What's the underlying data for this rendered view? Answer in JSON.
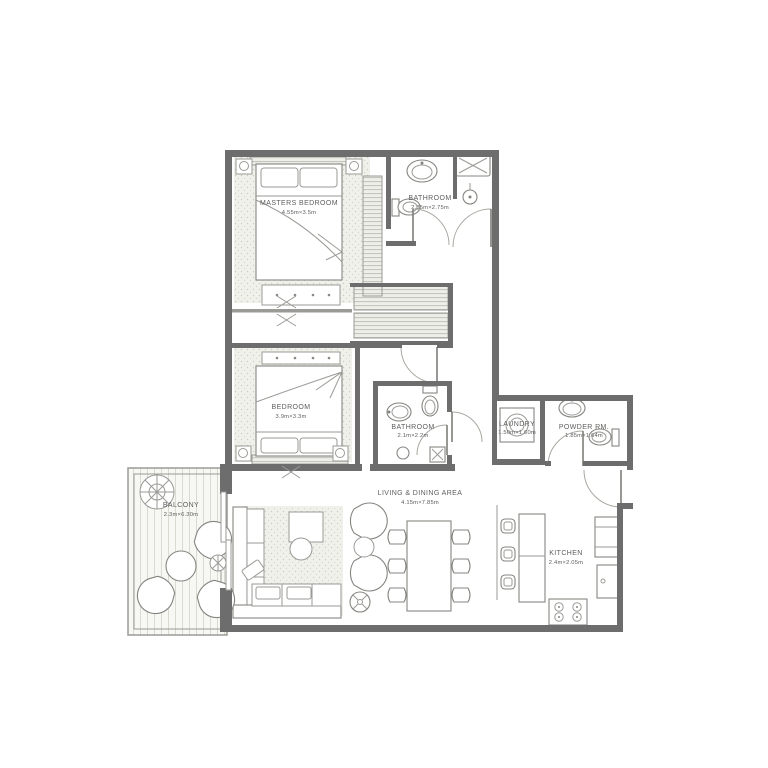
{
  "plan_title": "Two Bedroom Apartment Floor Plan",
  "rooms": {
    "masters_bedroom": {
      "name": "MASTERS BEDROOM",
      "dims": "4.55m×3.5m"
    },
    "bathroom1": {
      "name": "BATHROOM",
      "dims": "2.35m×2.75m"
    },
    "bedroom": {
      "name": "BEDROOM",
      "dims": "3.9m×3.3m"
    },
    "bathroom2": {
      "name": "BATHROOM",
      "dims": "2.1m×2.2m"
    },
    "laundry": {
      "name": "LAUNDRY",
      "dims": "1.50m×1.60m"
    },
    "powder": {
      "name": "POWDER RM.",
      "dims": "1.85m×1.64m"
    },
    "living": {
      "name": "LIVING & DINING AREA",
      "dims": "4.15m×7.85m"
    },
    "kitchen": {
      "name": "KITCHEN",
      "dims": "2.4m×2.05m"
    },
    "balcony": {
      "name": "BALCONY",
      "dims": "2.3m×6.30m"
    }
  },
  "colors": {
    "wall": "#6d6d6d",
    "line": "#9a9a96",
    "fixture": "#858580",
    "text": "#5e5e5e",
    "carpet": "#f1f1ec",
    "background": "#ffffff"
  }
}
